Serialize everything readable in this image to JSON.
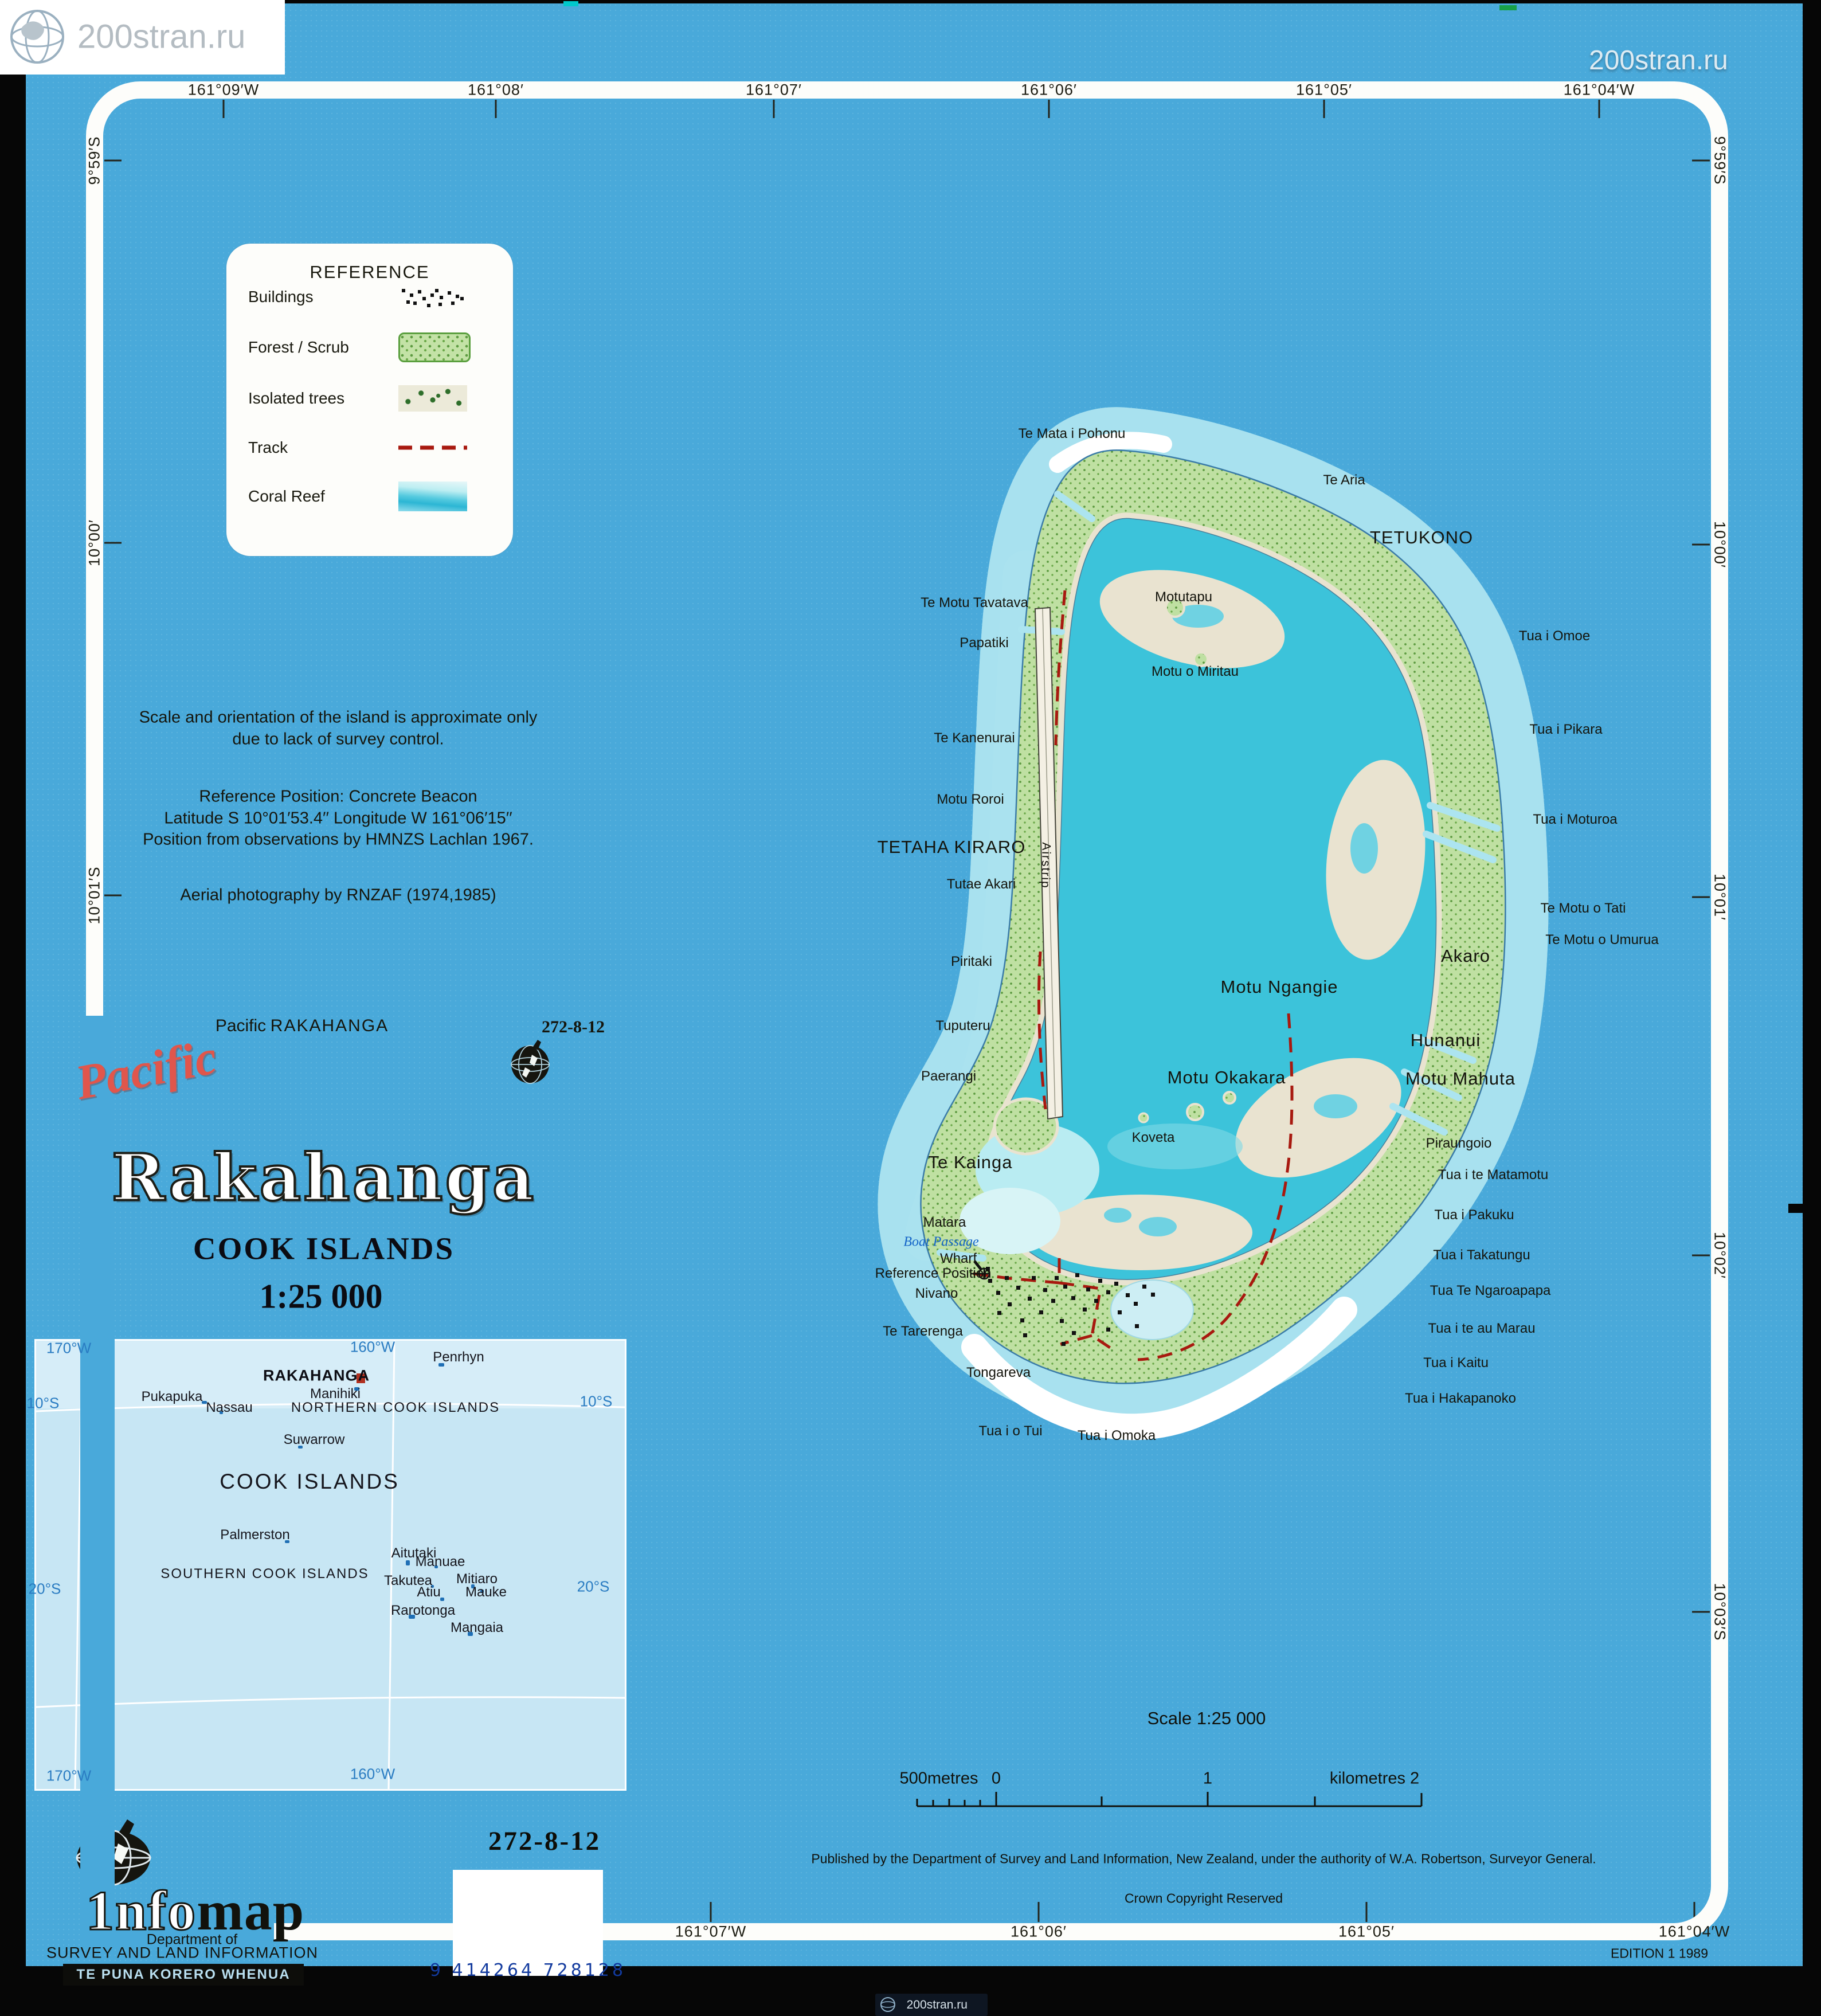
{
  "watermark": {
    "text": "200stran.ru"
  },
  "colors": {
    "sheet_blue": "#49a9da",
    "lagoon": "#3cc3da",
    "land_green": "#bfe0a2",
    "track_red": "#a8190f",
    "reef_white": "#ffffff",
    "title_red": "#e0564c",
    "inset_blue": "#c7e6f4",
    "barcode_blue": "#2257c4"
  },
  "frame": {
    "top": [
      [
        "161°09′W",
        390
      ],
      [
        "161°08′",
        865
      ],
      [
        "161°07′",
        1350
      ],
      [
        "161°06′",
        1830
      ],
      [
        "161°05′",
        2310
      ],
      [
        "161°04′W",
        2790
      ]
    ],
    "bottom": [
      [
        "161°07′W",
        1240
      ],
      [
        "161°06′",
        1812
      ],
      [
        "161°05′",
        2384
      ],
      [
        "161°04′W",
        2956
      ]
    ],
    "left": [
      [
        "9°59′S",
        280
      ],
      [
        "10°00′",
        947
      ],
      [
        "10°01′S",
        1562
      ]
    ],
    "right": [
      [
        "9°59′S",
        280
      ],
      [
        "10°00′",
        950
      ],
      [
        "10°01′",
        1565
      ],
      [
        "10°02′",
        2190
      ],
      [
        "10°03′S",
        2812
      ]
    ]
  },
  "legend": {
    "title": "REFERENCE",
    "items": [
      {
        "label": "Buildings",
        "symbol": "buildings"
      },
      {
        "label": "Forest / Scrub",
        "symbol": "forest"
      },
      {
        "label": "Isolated trees",
        "symbol": "trees"
      },
      {
        "label": "Track",
        "symbol": "track"
      },
      {
        "label": "Coral Reef",
        "symbol": "reef"
      }
    ]
  },
  "notes": {
    "line1": "Scale and orientation of the island is approximate only",
    "line2": "due to lack of survey control.",
    "ref1": "Reference Position: Concrete Beacon",
    "ref2": "Latitude S 10°01′53.4′′  Longitude W 161°06′15′′",
    "ref3": "Position from observations by HMNZS Lachlan 1967.",
    "aerial": "Aerial photography by RNZAF (1974,1985)"
  },
  "title_block": {
    "header_series": "Pacific",
    "header_name": "RAKAHANGA",
    "sheet_number": "272-8-12",
    "series_script": "Pacific",
    "title": "Rakahanga",
    "subtitle": "COOK ISLANDS",
    "scale": "1:25 000"
  },
  "map": {
    "labels": [
      [
        "Te Mata i Pohonu",
        1870,
        757,
        "s"
      ],
      [
        "Te Aria",
        2345,
        838,
        "s"
      ],
      [
        "TETUKONO",
        2480,
        938,
        "b"
      ],
      [
        "Te Motu Tavatava",
        1700,
        1052,
        "s"
      ],
      [
        "Motutapu",
        2065,
        1042,
        "s"
      ],
      [
        "Papatiki",
        1717,
        1122,
        "s"
      ],
      [
        "Motu o Miritau",
        2085,
        1172,
        "s"
      ],
      [
        "Tua i Omoe",
        2712,
        1110,
        "s"
      ],
      [
        "Te Kanenurai",
        1700,
        1288,
        "s"
      ],
      [
        "Tua i Pikara",
        2732,
        1273,
        "s"
      ],
      [
        "Motu Roroi",
        1693,
        1395,
        "s"
      ],
      [
        "TETAHA KIRARO",
        1660,
        1478,
        "b"
      ],
      [
        "Tua i Moturoa",
        2748,
        1430,
        "s"
      ],
      [
        "Tutae Akari",
        1712,
        1543,
        "s"
      ],
      [
        "Te Motu o Tati",
        2762,
        1585,
        "s"
      ],
      [
        "Te Motu o Umurua",
        2795,
        1640,
        "s"
      ],
      [
        "Piritaki",
        1695,
        1678,
        "s"
      ],
      [
        "Akaro",
        2557,
        1668,
        "b"
      ],
      [
        "Motu Ngangie",
        2232,
        1722,
        "b"
      ],
      [
        "Tuputeru",
        1680,
        1790,
        "s"
      ],
      [
        "Hunanui",
        2522,
        1815,
        "b"
      ],
      [
        "Paerangi",
        1655,
        1878,
        "s"
      ],
      [
        "Motu Okakara",
        2140,
        1880,
        "b"
      ],
      [
        "Motu Mahuta",
        2548,
        1882,
        "b"
      ],
      [
        "Koveta",
        2012,
        1985,
        "s"
      ],
      [
        "Piraungoio",
        2545,
        1995,
        "s"
      ],
      [
        "Te Kainga",
        1693,
        2028,
        "b"
      ],
      [
        "Tua i te Matamotu",
        2605,
        2050,
        "s"
      ],
      [
        "Tua i Pakuku",
        2572,
        2120,
        "s"
      ],
      [
        "Matara",
        1648,
        2133,
        "s"
      ],
      [
        "Boat Passage",
        1642,
        2167,
        "w"
      ],
      [
        "Tua i Takatungu",
        2585,
        2190,
        "s"
      ],
      [
        "Wharf",
        1672,
        2196,
        "s"
      ],
      [
        "Reference Position",
        1628,
        2222,
        "s"
      ],
      [
        "Nivano",
        1634,
        2257,
        "s"
      ],
      [
        "Tua Te Ngaroapapa",
        2600,
        2252,
        "s"
      ],
      [
        "Tua i te au Marau",
        2585,
        2318,
        "s"
      ],
      [
        "Te Tarerenga",
        1610,
        2323,
        "s"
      ],
      [
        "Tua i Kaitu",
        2540,
        2378,
        "s"
      ],
      [
        "Tongareva",
        1742,
        2395,
        "s"
      ],
      [
        "Tua i Hakapanoko",
        2548,
        2440,
        "s"
      ],
      [
        "Tua i o Tui",
        1763,
        2497,
        "s"
      ],
      [
        "Tua i Omoka",
        1948,
        2505,
        "s"
      ],
      [
        "Airstrip",
        1824,
        1510,
        "rot"
      ]
    ],
    "buildings": [
      [
        1724,
        2231
      ],
      [
        1738,
        2252
      ],
      [
        1753,
        2226
      ],
      [
        1758,
        2272
      ],
      [
        1773,
        2243
      ],
      [
        1780,
        2300
      ],
      [
        1793,
        2262
      ],
      [
        1800,
        2226
      ],
      [
        1813,
        2286
      ],
      [
        1820,
        2247
      ],
      [
        1834,
        2266
      ],
      [
        1840,
        2226
      ],
      [
        1849,
        2301
      ],
      [
        1855,
        2241
      ],
      [
        1869,
        2261
      ],
      [
        1876,
        2221
      ],
      [
        1889,
        2281
      ],
      [
        1895,
        2246
      ],
      [
        1909,
        2266
      ],
      [
        1916,
        2231
      ],
      [
        1930,
        2251
      ],
      [
        1944,
        2236
      ],
      [
        1950,
        2286
      ],
      [
        1964,
        2256
      ],
      [
        1978,
        2271
      ],
      [
        1993,
        2241
      ],
      [
        1870,
        2322
      ],
      [
        1930,
        2316
      ],
      [
        1852,
        2341
      ],
      [
        1785,
        2326
      ],
      [
        1740,
        2287
      ],
      [
        1980,
        2310
      ],
      [
        2008,
        2255
      ],
      [
        1720,
        2210
      ]
    ]
  },
  "inset": {
    "labels": [
      [
        "170°W",
        120,
        2352,
        "c"
      ],
      [
        "160°W",
        650,
        2350,
        "c"
      ],
      [
        "Penrhyn",
        800,
        2368,
        "n"
      ],
      [
        "RAKAHANGA",
        552,
        2400,
        "R"
      ],
      [
        "10°S",
        75,
        2448,
        "c"
      ],
      [
        "10°S",
        1040,
        2445,
        "c"
      ],
      [
        "Manihiki",
        585,
        2432,
        "n"
      ],
      [
        "Pukapuka",
        300,
        2437,
        "n"
      ],
      [
        "Nassau",
        400,
        2456,
        "n"
      ],
      [
        "NORTHERN COOK ISLANDS",
        690,
        2456,
        "N"
      ],
      [
        "Suwarrow",
        548,
        2512,
        "n"
      ],
      [
        "COOK ISLANDS",
        540,
        2585,
        "B"
      ],
      [
        "Palmerston",
        445,
        2678,
        "n"
      ],
      [
        "Aitutaki",
        722,
        2710,
        "n"
      ],
      [
        "Manuae",
        768,
        2725,
        "n"
      ],
      [
        "SOUTHERN COOK ISLANDS",
        462,
        2746,
        "N"
      ],
      [
        "Takutea",
        712,
        2758,
        "n"
      ],
      [
        "Mitiaro",
        832,
        2755,
        "n"
      ],
      [
        "Atiu",
        748,
        2778,
        "n"
      ],
      [
        "Mauke",
        848,
        2778,
        "n"
      ],
      [
        "20°S",
        78,
        2772,
        "c"
      ],
      [
        "20°S",
        1035,
        2768,
        "c"
      ],
      [
        "Rarotonga",
        738,
        2810,
        "n"
      ],
      [
        "Mangaia",
        832,
        2840,
        "n"
      ],
      [
        "170°W",
        120,
        3098,
        "c"
      ],
      [
        "160°W",
        650,
        3095,
        "c"
      ]
    ],
    "islets": [
      [
        765,
        2378,
        10,
        6
      ],
      [
        618,
        2420,
        9,
        6
      ],
      [
        352,
        2444,
        9,
        5
      ],
      [
        383,
        2462,
        6,
        5
      ],
      [
        520,
        2522,
        8,
        5
      ],
      [
        497,
        2687,
        8,
        5
      ],
      [
        708,
        2722,
        7,
        9
      ],
      [
        758,
        2731,
        6,
        5
      ],
      [
        752,
        2765,
        5,
        5
      ],
      [
        822,
        2764,
        6,
        7
      ],
      [
        768,
        2787,
        7,
        6
      ],
      [
        838,
        2773,
        6,
        6
      ],
      [
        713,
        2817,
        11,
        7
      ],
      [
        816,
        2847,
        9,
        7
      ]
    ],
    "marker": [
      622,
      2396,
      15,
      17
    ]
  },
  "scalebar": {
    "title": "Scale 1:25 000",
    "left_label": "500metres",
    "zero": "0",
    "one": "1",
    "right_label": "kilometres 2"
  },
  "footer": {
    "published": "Published by the Department of Survey and Land Information, New Zealand, under the authority of W.A. Robertson, Surveyor General.",
    "copyright": "Crown Copyright Reserved",
    "edition": "EDITION 1 1989",
    "sheet_number": "272-8-12",
    "barcode_text": "9 414264 728128"
  },
  "logo": {
    "word_a": "1nfo",
    "word_b": "map",
    "dept1": "Department of",
    "dept2": "SURVEY AND LAND INFORMATION",
    "maori": "TE PUNA KORERO WHENUA"
  }
}
